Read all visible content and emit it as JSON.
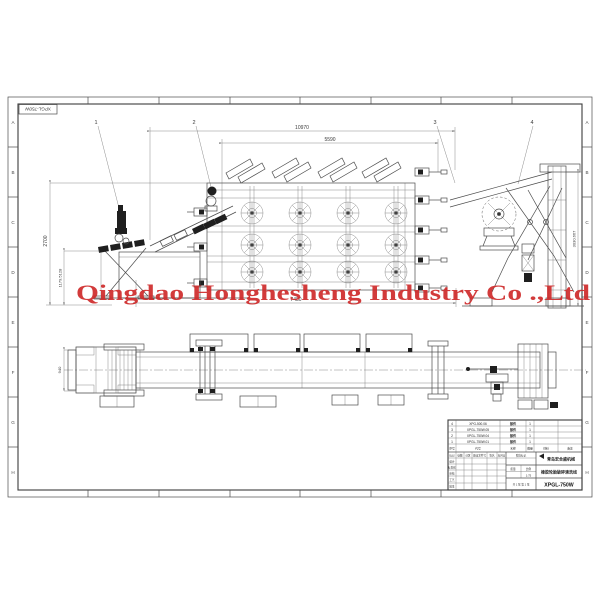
{
  "sheet": {
    "corner_label": "XPGL-750W",
    "row_letters": [
      "A",
      "B",
      "C",
      "D",
      "E",
      "F",
      "G",
      "H"
    ],
    "watermark": "Qingdao Honghesheng Industry Co .,Ltd",
    "watermark_color": "#cf2b2b"
  },
  "dimensions": {
    "overall_length": "10970",
    "body_length": "5590",
    "feed_height": "2700",
    "feed_lower_height": "1179.5128",
    "body_width": "7480",
    "discharge_height": "3030.667",
    "conveyor_width": "940"
  },
  "callouts": {
    "c1": "1",
    "c2": "2",
    "c3": "3",
    "c4": "4"
  },
  "parts_table": {
    "headers": [
      "序号",
      "代号",
      "名称",
      "数量",
      "材料",
      "备注"
    ],
    "rows": [
      {
        "seq": "4",
        "code": "XPG-500.06",
        "name": "部件",
        "qty": "1"
      },
      {
        "seq": "3",
        "code": "XPGL-750W.05",
        "name": "部件",
        "qty": "1"
      },
      {
        "seq": "2",
        "code": "XPGL-750W.04",
        "name": "部件",
        "qty": "1"
      },
      {
        "seq": "1",
        "code": "XPGL-750W.01",
        "name": "部件",
        "qty": "1"
      }
    ]
  },
  "title_block": {
    "revision_headers": [
      "标记",
      "处数",
      "分区",
      "更改文件号",
      "签名",
      "年月日"
    ],
    "sign_labels": [
      "设计",
      "标准化",
      "审核",
      "工艺",
      "批准"
    ],
    "stage_label": "阶段标记",
    "mass_label": "质量",
    "scale_label": "比例",
    "scale_value": "1:75",
    "sheet_info": "共 1 张 第 1 张",
    "company": "青岛宏合盛机械",
    "product_name": "橡胶轮胎破碎清洗线",
    "drawing_number": "XPGL-750W"
  }
}
